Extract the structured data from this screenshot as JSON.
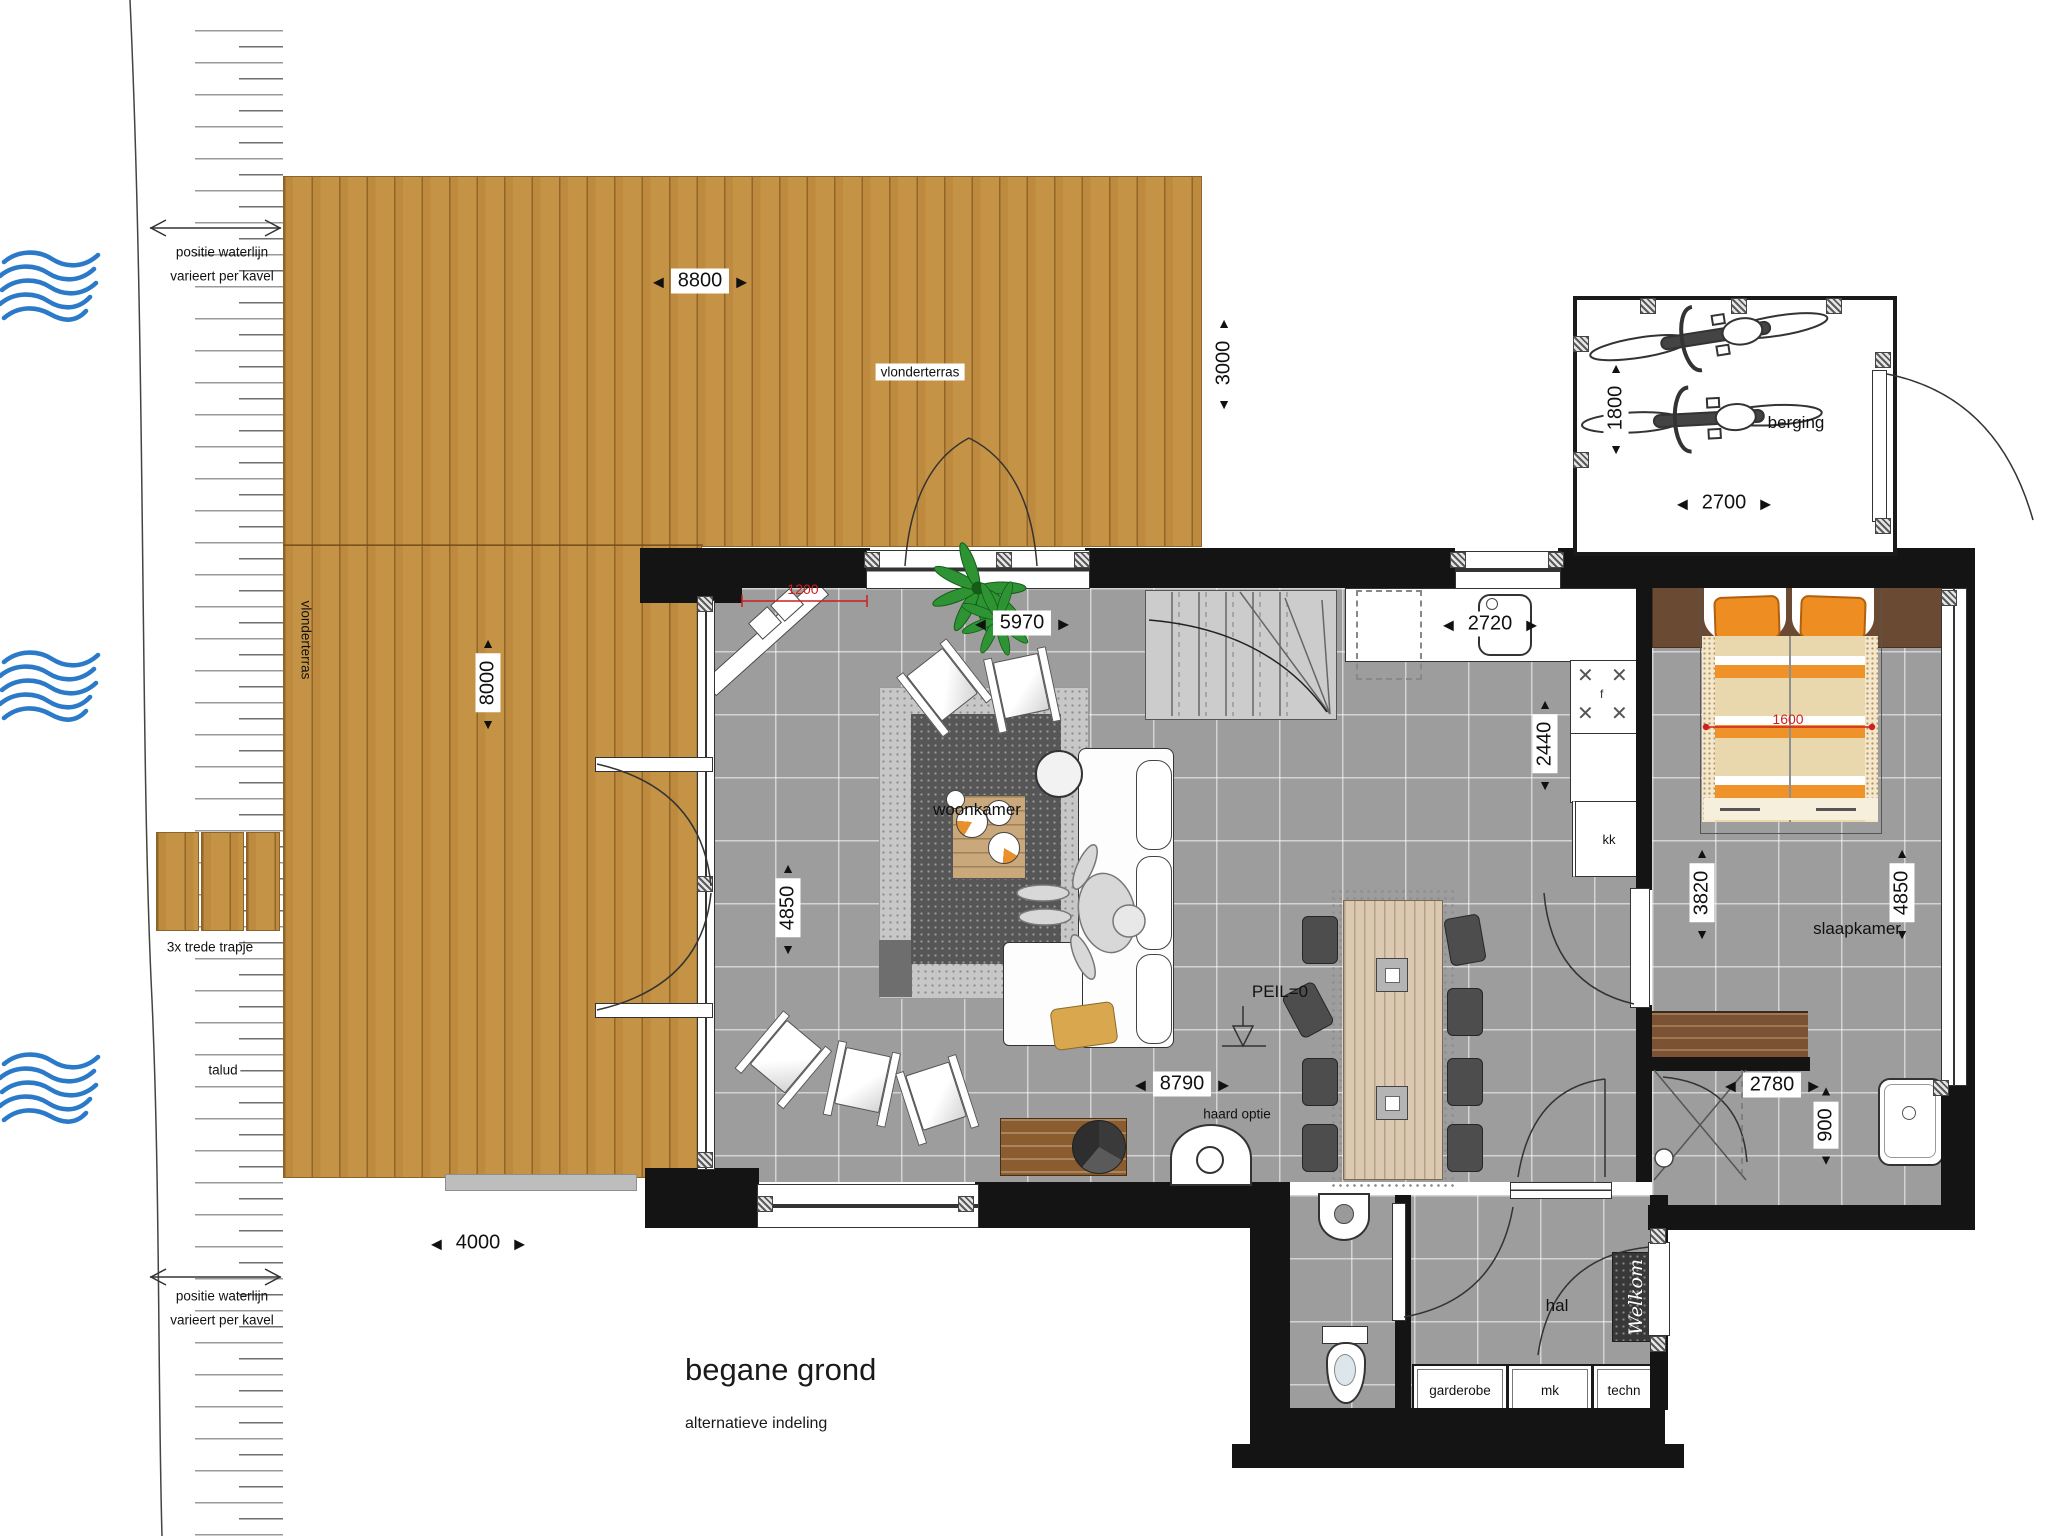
{
  "title": {
    "main": "begane grond",
    "subtitle": "alternatieve indeling"
  },
  "icons": {
    "arrow_left": "◀",
    "arrow_right": "▶",
    "arrow_up": "▲",
    "arrow_down": "▼"
  },
  "site": {
    "waterline_top_line1": "positie waterlijn",
    "waterline_top_line2": "varieert per kavel",
    "waterline_bottom_line1": "positie waterlijn",
    "waterline_bottom_line2": "varieert per kavel",
    "steps_label": "3x trede  trapje",
    "slope_label": "talud"
  },
  "deck": {
    "label_top": "vlonderterras",
    "label_side": "vlonderterras",
    "dim_width": "8800",
    "dim_height": "8000",
    "dim_north_strip": "3000",
    "dim_south": "4000",
    "dim_door_red": "1200"
  },
  "berging": {
    "label": "berging",
    "dim_width": "2700",
    "dim_bikes": "1800"
  },
  "living": {
    "label": "woonkamer",
    "dim_width": "5970",
    "dim_height": "4850",
    "dim_south": "8790",
    "fireplace_label": "haard optie",
    "datum_label": "PEIL=0"
  },
  "kitchen": {
    "dim_width": "2720",
    "dim_depth": "2440",
    "hob_label": "f",
    "unit_label": "kk"
  },
  "bedroom": {
    "label": "slaapkamer",
    "dim_bed_red": "1600",
    "dim_left": "3820",
    "dim_right": "4850",
    "dim_south": "2780",
    "dim_bath": "900"
  },
  "hall": {
    "label": "hal",
    "mat_label": "Welkom",
    "cabinets": [
      {
        "label": "garderobe"
      },
      {
        "label": "mk"
      },
      {
        "label": "techn"
      }
    ]
  },
  "colors": {
    "wood": "#c59345",
    "floor": "#9d9d9d",
    "wall": "#141414",
    "accent_orange": "#ee8d21",
    "water_blue": "#2b7ac9",
    "dim_red": "#cf1f1f"
  }
}
